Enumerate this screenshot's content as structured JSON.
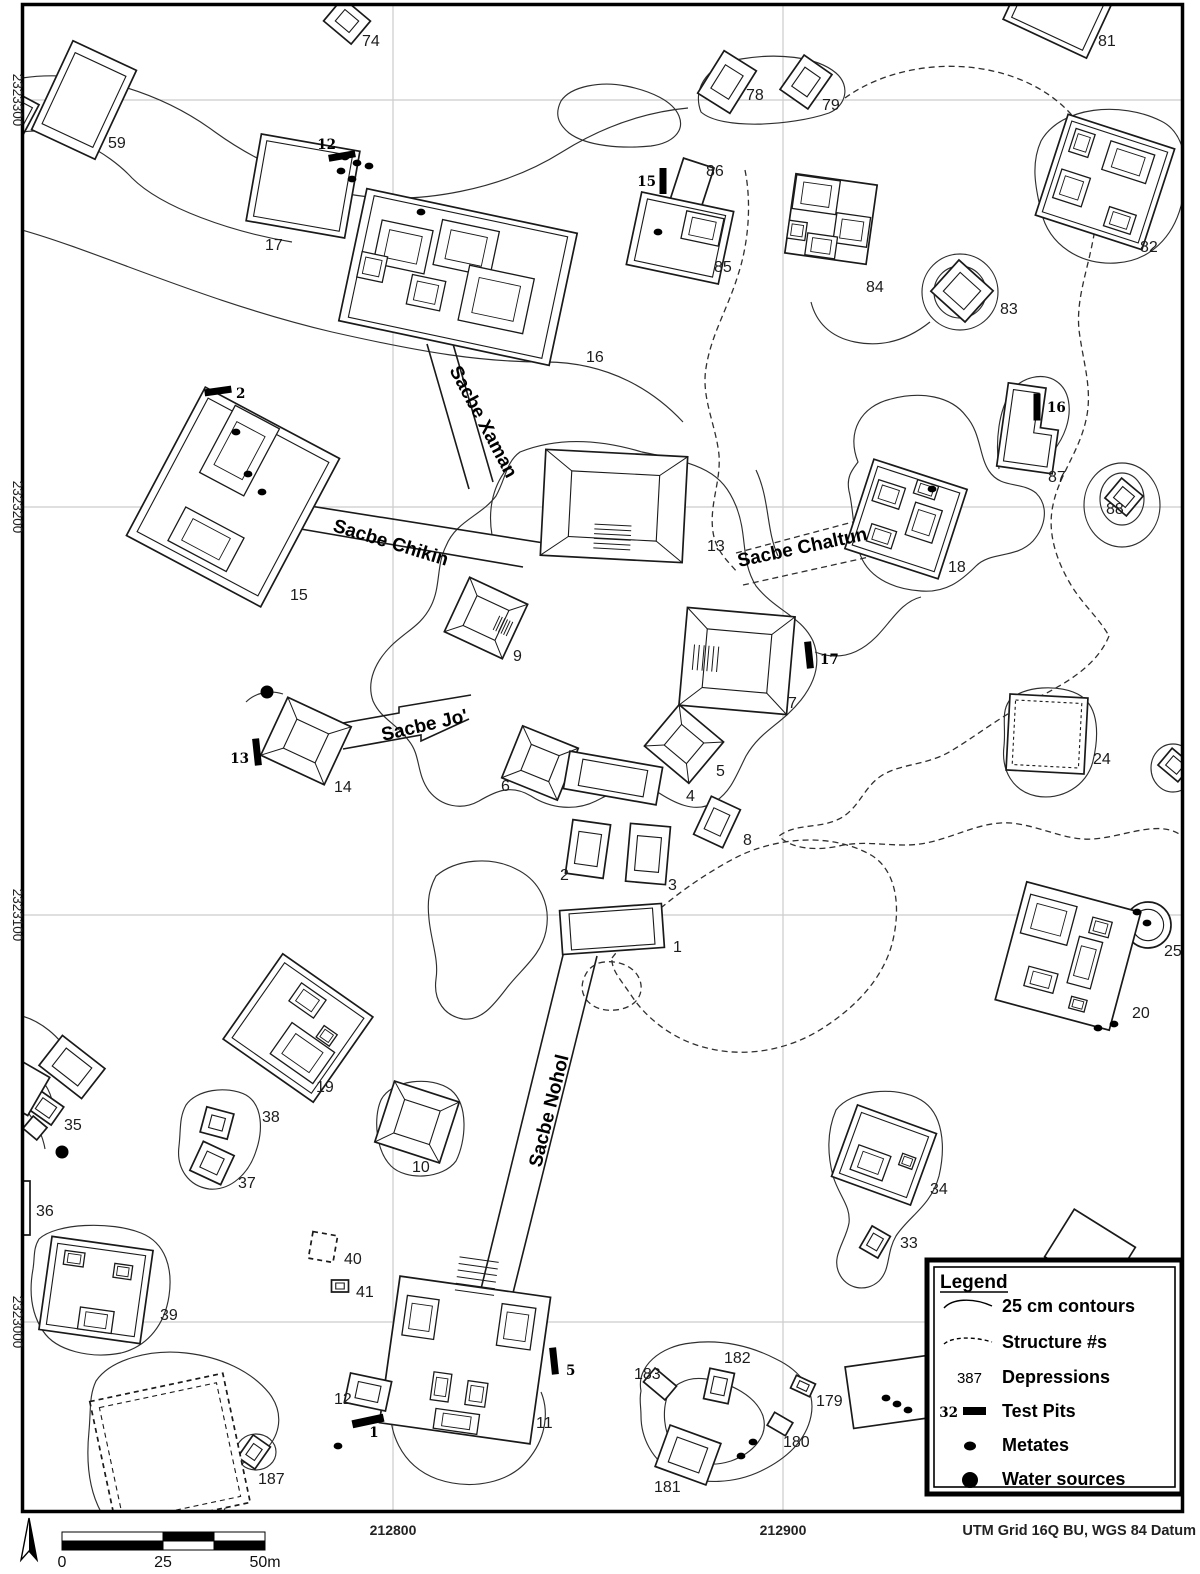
{
  "map": {
    "axis": {
      "left_labels": [
        {
          "text": "2323300",
          "y": 100
        },
        {
          "text": "2323200",
          "y": 507
        },
        {
          "text": "2323100",
          "y": 915
        },
        {
          "text": "2323000",
          "y": 1322
        }
      ],
      "bottom_labels": [
        {
          "text": "212800",
          "x": 393
        },
        {
          "text": "212900",
          "x": 783
        }
      ],
      "datum_note": "UTM Grid 16Q BU, WGS 84 Datum"
    },
    "grid": {
      "vxs": [
        393,
        783
      ],
      "hys": [
        100,
        507,
        915,
        1322
      ]
    },
    "sacbes": [
      {
        "name": "Sacbe Xaman",
        "x": 449,
        "y": 370,
        "angle": 62
      },
      {
        "name": "Sacbe Chikin",
        "x": 332,
        "y": 531,
        "angle": 17
      },
      {
        "name": "Sacbe Chaltun",
        "x": 739,
        "y": 567,
        "angle": -12
      },
      {
        "name": "Sacbe Jo'",
        "x": 383,
        "y": 741,
        "angle": -13
      },
      {
        "name": "Sacbe Nohol",
        "x": 541,
        "y": 1168,
        "angle": -76
      }
    ],
    "structures": [
      {
        "n": "74",
        "cx": 347,
        "cy": 21,
        "w": 36,
        "h": 30,
        "rot": 40,
        "rings": 2,
        "is": 0.5,
        "lx": 362,
        "ly": 46
      },
      {
        "n": "59",
        "cx": 84,
        "cy": 100,
        "w": 70,
        "h": 98,
        "rot": 25,
        "rings": 2,
        "is": 0.8,
        "lx": 108,
        "ly": 148
      },
      {
        "n": "8",
        "cx": 6,
        "cy": 120,
        "w": 44,
        "h": 58,
        "rot": 28,
        "rings": 2,
        "is": 0.8,
        "lx": 13,
        "ly": 150
      },
      {
        "n": "17",
        "cx": 303,
        "cy": 186,
        "w": 100,
        "h": 88,
        "rot": 10,
        "rings": 2,
        "is": 0.87,
        "lx": 265,
        "ly": 250
      },
      {
        "n": "16",
        "cx": 458,
        "cy": 277,
        "w": 215,
        "h": 135,
        "rot": 12,
        "rings": 2,
        "is": 0.92,
        "inner": [
          [
            -60,
            -18,
            52,
            44
          ],
          [
            2,
            -30,
            58,
            46
          ],
          [
            42,
            14,
            66,
            56
          ],
          [
            -28,
            22,
            34,
            30
          ],
          [
            -86,
            8,
            26,
            26
          ]
        ],
        "lx": 586,
        "ly": 362
      },
      {
        "n": "86",
        "cx": 692,
        "cy": 184,
        "w": 32,
        "h": 44,
        "rot": 18,
        "rings": 1,
        "lx": 706,
        "ly": 176
      },
      {
        "n": "85",
        "cx": 680,
        "cy": 238,
        "w": 94,
        "h": 74,
        "rot": 12,
        "rings": 2,
        "is": 0.85,
        "inner": [
          [
            20,
            -14,
            38,
            28
          ]
        ],
        "lx": 714,
        "ly": 272
      },
      {
        "n": "78",
        "cx": 727,
        "cy": 82,
        "w": 38,
        "h": 50,
        "rot": 32,
        "rings": 2,
        "is": 0.55,
        "lx": 746,
        "ly": 100
      },
      {
        "n": "79",
        "cx": 806,
        "cy": 82,
        "w": 34,
        "h": 42,
        "rot": 35,
        "rings": 2,
        "is": 0.55,
        "lx": 822,
        "ly": 110
      },
      {
        "n": "84",
        "cx": 831,
        "cy": 219,
        "w": 82,
        "h": 80,
        "rot": 8,
        "rings": 1,
        "inner": [
          [
            -18,
            -22,
            44,
            34
          ],
          [
            22,
            8,
            34,
            30
          ],
          [
            -6,
            28,
            30,
            22
          ],
          [
            -32,
            16,
            18,
            18
          ]
        ],
        "lx": 866,
        "ly": 292
      },
      {
        "n": "83",
        "cx": 962,
        "cy": 291,
        "w": 46,
        "h": 42,
        "rot": 42,
        "rings": 2,
        "is": 0.6,
        "lx": 1000,
        "ly": 314
      },
      {
        "n": "82",
        "cx": 1105,
        "cy": 182,
        "w": 112,
        "h": 106,
        "rot": 18,
        "rings": 2,
        "is": 0.9,
        "inner": [
          [
            16,
            -26,
            46,
            30
          ],
          [
            -30,
            16,
            30,
            30
          ],
          [
            26,
            32,
            28,
            20
          ],
          [
            -34,
            -30,
            20,
            24
          ]
        ],
        "lx": 1140,
        "ly": 252
      },
      {
        "n": "81",
        "cx": 1060,
        "cy": 6,
        "w": 92,
        "h": 72,
        "rot": 25,
        "rings": 2,
        "is": 0.85,
        "lx": 1098,
        "ly": 46
      },
      {
        "n": "15",
        "cx": 233,
        "cy": 497,
        "w": 152,
        "h": 168,
        "rot": 28,
        "rings": 2,
        "is": 0.9,
        "inner": [
          [
            -16,
            -44,
            50,
            76
          ],
          [
            -4,
            50,
            66,
            38
          ]
        ],
        "lx": 290,
        "ly": 600
      },
      {
        "n": "13",
        "cx": 614,
        "cy": 506,
        "w": 142,
        "h": 106,
        "rot": 3,
        "rings": 2,
        "is": 0.62,
        "pyr": true,
        "stairs": "s",
        "lx": 707,
        "ly": 551
      },
      {
        "n": "9",
        "cx": 486,
        "cy": 618,
        "w": 64,
        "h": 60,
        "rot": 25,
        "rings": 2,
        "is": 0.55,
        "pyr": true,
        "stairs": "e",
        "lx": 513,
        "ly": 661
      },
      {
        "n": "18",
        "cx": 906,
        "cy": 519,
        "w": 98,
        "h": 94,
        "rot": 18,
        "rings": 2,
        "is": 0.88,
        "inner": [
          [
            -24,
            -18,
            28,
            22
          ],
          [
            18,
            -2,
            28,
            34
          ],
          [
            -18,
            24,
            26,
            18
          ],
          [
            10,
            -34,
            22,
            14
          ]
        ],
        "lx": 948,
        "ly": 572
      },
      {
        "n": "87",
        "cx": 1028,
        "cy": 430,
        "rot": 8,
        "shape": "L",
        "lx": 1048,
        "ly": 482
      },
      {
        "n": "88",
        "cx": 1124,
        "cy": 497,
        "w": 28,
        "h": 26,
        "rot": 40,
        "rings": 2,
        "is": 0.55,
        "lx": 1106,
        "ly": 514
      },
      {
        "n": "7",
        "cx": 737,
        "cy": 661,
        "w": 108,
        "h": 98,
        "rot": 5,
        "rings": 2,
        "is": 0.6,
        "pyr": true,
        "stairs": "w",
        "lx": 788,
        "ly": 708
      },
      {
        "n": "24",
        "cx": 1047,
        "cy": 734,
        "w": 78,
        "h": 76,
        "rot": 3,
        "rings": 2,
        "is": 0.85,
        "inner_dashed": true,
        "lx": 1093,
        "ly": 764
      },
      {
        "n": "",
        "cx": 1175,
        "cy": 765,
        "w": 26,
        "h": 22,
        "rot": 40,
        "rings": 2,
        "is": 0.55
      },
      {
        "n": "14",
        "cx": 306,
        "cy": 741,
        "w": 70,
        "h": 64,
        "rot": 25,
        "rings": 2,
        "is": 0.5,
        "pyr": true,
        "lx": 334,
        "ly": 792
      },
      {
        "n": "6",
        "cx": 540,
        "cy": 763,
        "w": 60,
        "h": 56,
        "rot": 22,
        "rings": 2,
        "is": 0.5,
        "pyr": true,
        "lx": 501,
        "ly": 791
      },
      {
        "n": "5",
        "cx": 684,
        "cy": 744,
        "w": 58,
        "h": 54,
        "rot": 40,
        "rings": 2,
        "is": 0.5,
        "pyr": true,
        "lx": 716,
        "ly": 776
      },
      {
        "n": "4",
        "cx": 613,
        "cy": 778,
        "w": 94,
        "h": 38,
        "rot": 10,
        "rings": 2,
        "is": 0.7,
        "lx": 686,
        "ly": 801
      },
      {
        "n": "8",
        "cx": 717,
        "cy": 822,
        "w": 32,
        "h": 42,
        "rot": 25,
        "rings": 2,
        "is": 0.55,
        "lx": 743,
        "ly": 845
      },
      {
        "n": "2",
        "cx": 588,
        "cy": 849,
        "w": 38,
        "h": 54,
        "rot": 8,
        "rings": 2,
        "is": 0.6,
        "lx": 560,
        "ly": 880
      },
      {
        "n": "3",
        "cx": 648,
        "cy": 854,
        "w": 40,
        "h": 58,
        "rot": 5,
        "rings": 2,
        "is": 0.6,
        "lx": 668,
        "ly": 890
      },
      {
        "n": "1",
        "cx": 612,
        "cy": 929,
        "w": 102,
        "h": 44,
        "rot": -4,
        "rings": 2,
        "is": 0.82,
        "lx": 673,
        "ly": 952
      },
      {
        "n": "19",
        "cx": 298,
        "cy": 1028,
        "w": 110,
        "h": 104,
        "rot": 35,
        "rings": 2,
        "is": 0.88,
        "inner": [
          [
            -8,
            -28,
            30,
            22
          ],
          [
            18,
            18,
            52,
            38
          ],
          [
            28,
            -10,
            16,
            14
          ]
        ],
        "lx": 316,
        "ly": 1092
      },
      {
        "n": "10",
        "cx": 417,
        "cy": 1122,
        "w": 68,
        "h": 64,
        "rot": 18,
        "rings": 2,
        "is": 0.55,
        "pyr": true,
        "lx": 412,
        "ly": 1172
      },
      {
        "n": "38",
        "cx": 217,
        "cy": 1123,
        "w": 28,
        "h": 26,
        "rot": 15,
        "rings": 2,
        "is": 0.5,
        "lx": 262,
        "ly": 1122
      },
      {
        "n": "37",
        "cx": 212,
        "cy": 1163,
        "w": 34,
        "h": 32,
        "rot": 25,
        "rings": 2,
        "is": 0.55,
        "lx": 238,
        "ly": 1188
      },
      {
        "n": "35",
        "cx": 72,
        "cy": 1067,
        "w": 54,
        "h": 38,
        "rot": 38,
        "rings": 2,
        "is": 0.6,
        "lx": 64,
        "ly": 1130
      },
      {
        "n": "",
        "cx": 46,
        "cy": 1108,
        "w": 28,
        "h": 22,
        "rot": 35,
        "rings": 2,
        "is": 0.6
      },
      {
        "n": "",
        "cx": 35,
        "cy": 1128,
        "w": 18,
        "h": 16,
        "rot": 40,
        "rings": 1
      },
      {
        "n": "",
        "cx": 24,
        "cy": 1088,
        "w": 34,
        "h": 44,
        "rot": 30,
        "rings": 1
      },
      {
        "n": "36",
        "cx": 26,
        "cy": 1208,
        "w": 8,
        "h": 54,
        "rot": 0,
        "rings": 1,
        "lx": 36,
        "ly": 1216
      },
      {
        "n": "39",
        "cx": 96,
        "cy": 1290,
        "w": 102,
        "h": 94,
        "rot": 8,
        "rings": 2,
        "is": 0.87,
        "inner": [
          [
            -26,
            -28,
            20,
            14
          ],
          [
            24,
            -22,
            18,
            14
          ],
          [
            4,
            30,
            34,
            22
          ]
        ],
        "lx": 160,
        "ly": 1320
      },
      {
        "n": "40",
        "cx": 323,
        "cy": 1247,
        "w": 25,
        "h": 27,
        "rot": 10,
        "rings": 1,
        "dashed": true,
        "lx": 344,
        "ly": 1264
      },
      {
        "n": "41",
        "cx": 340,
        "cy": 1286,
        "w": 17,
        "h": 12,
        "rot": 0,
        "rings": 2,
        "is": 0.5,
        "lx": 356,
        "ly": 1297
      },
      {
        "n": "11",
        "cx": 465,
        "cy": 1360,
        "w": 152,
        "h": 148,
        "rot": 8,
        "rings": 1,
        "stairs": "n",
        "inner": [
          [
            -50,
            -36,
            32,
            40
          ],
          [
            46,
            -40,
            34,
            42
          ],
          [
            -20,
            30,
            18,
            28
          ],
          [
            16,
            32,
            20,
            24
          ],
          [
            0,
            62,
            44,
            20
          ]
        ],
        "lx": 536,
        "ly": 1428
      },
      {
        "n": "12",
        "cx": 368,
        "cy": 1392,
        "w": 42,
        "h": 30,
        "rot": 12,
        "rings": 2,
        "is": 0.55,
        "lx": 334,
        "ly": 1404
      },
      {
        "n": "183",
        "cx": 660,
        "cy": 1384,
        "w": 28,
        "h": 18,
        "rot": 40,
        "rings": 1,
        "lx": 634,
        "ly": 1379
      },
      {
        "n": "182",
        "cx": 719,
        "cy": 1386,
        "w": 25,
        "h": 31,
        "rot": 12,
        "rings": 2,
        "is": 0.55,
        "lx": 724,
        "ly": 1363
      },
      {
        "n": "181",
        "cx": 688,
        "cy": 1455,
        "w": 54,
        "h": 44,
        "rot": 20,
        "rings": 2,
        "is": 0.6,
        "lx": 654,
        "ly": 1492
      },
      {
        "n": "179",
        "cx": 803,
        "cy": 1386,
        "w": 21,
        "h": 14,
        "rot": 25,
        "rings": 2,
        "is": 0.5,
        "lx": 816,
        "ly": 1406
      },
      {
        "n": "180",
        "cx": 780,
        "cy": 1424,
        "w": 21,
        "h": 15,
        "rot": 30,
        "rings": 1,
        "lx": 783,
        "ly": 1447
      },
      {
        "n": "34",
        "cx": 884,
        "cy": 1155,
        "w": 84,
        "h": 76,
        "rot": 20,
        "rings": 2,
        "is": 0.85,
        "inner": [
          [
            -10,
            12,
            34,
            26
          ],
          [
            24,
            -2,
            14,
            12
          ]
        ],
        "lx": 930,
        "ly": 1194
      },
      {
        "n": "33",
        "cx": 875,
        "cy": 1242,
        "w": 21,
        "h": 25,
        "rot": 30,
        "rings": 2,
        "is": 0.55,
        "lx": 900,
        "ly": 1248
      },
      {
        "n": "187",
        "cx": 254,
        "cy": 1452,
        "w": 21,
        "h": 27,
        "rot": 35,
        "rings": 2,
        "is": 0.5,
        "lx": 258,
        "ly": 1484
      },
      {
        "n": "",
        "cx": 170,
        "cy": 1452,
        "w": 136,
        "h": 132,
        "rot": -12,
        "rings": 2,
        "is": 0.88,
        "dashed": true
      },
      {
        "n": "",
        "cx": 890,
        "cy": 1392,
        "w": 82,
        "h": 62,
        "rot": -8,
        "rings": 1
      },
      {
        "n": "",
        "cx": 1090,
        "cy": 1252,
        "w": 72,
        "h": 56,
        "rot": 32,
        "rings": 1
      },
      {
        "n": "",
        "cx": 1184,
        "cy": 1404,
        "w": 28,
        "h": 28,
        "rot": 45,
        "rings": 2,
        "is": 0.5
      },
      {
        "n": "25",
        "cx": 1148,
        "cy": 925,
        "shape": "circle",
        "r": 23,
        "lx": 1164,
        "ly": 956
      },
      {
        "n": "20",
        "cx": 1068,
        "cy": 956,
        "w": 118,
        "h": 122,
        "rot": 15,
        "rings": 1,
        "inner": [
          [
            -28,
            -30,
            48,
            40
          ],
          [
            24,
            -36,
            20,
            16
          ],
          [
            18,
            2,
            24,
            48
          ],
          [
            -20,
            30,
            30,
            20
          ],
          [
            22,
            44,
            16,
            12
          ]
        ],
        "lx": 1132,
        "ly": 1018
      }
    ],
    "test_pits": [
      {
        "n": "12",
        "bx": 342,
        "by": 156,
        "bw": 27,
        "bh": 7,
        "rot": -10,
        "lx": 336,
        "ly": 149,
        "ta": "end"
      },
      {
        "n": "2",
        "bx": 218,
        "by": 391,
        "bw": 27,
        "bh": 7,
        "rot": -8,
        "lx": 236,
        "ly": 398,
        "ta": "start"
      },
      {
        "n": "15",
        "bx": 663,
        "by": 181,
        "bw": 7,
        "bh": 26,
        "rot": 0,
        "lx": 656,
        "ly": 186,
        "ta": "end"
      },
      {
        "n": "16",
        "bx": 1037,
        "by": 407,
        "bw": 7,
        "bh": 27,
        "rot": 0,
        "lx": 1047,
        "ly": 412,
        "ta": "start"
      },
      {
        "n": "17",
        "bx": 809,
        "by": 655,
        "bw": 7,
        "bh": 27,
        "rot": -6,
        "lx": 820,
        "ly": 664,
        "ta": "start"
      },
      {
        "n": "13",
        "bx": 257,
        "by": 752,
        "bw": 7,
        "bh": 27,
        "rot": -6,
        "lx": 249,
        "ly": 763,
        "ta": "end"
      },
      {
        "n": "5",
        "bx": 554,
        "by": 1361,
        "bw": 7,
        "bh": 27,
        "rot": -6,
        "lx": 566,
        "ly": 1375,
        "ta": "start"
      },
      {
        "n": "1",
        "bx": 368,
        "by": 1421,
        "bw": 32,
        "bh": 8,
        "rot": -12,
        "lx": 374,
        "ly": 1437,
        "ta": "middle"
      }
    ],
    "metates": [
      [
        345,
        157
      ],
      [
        357,
        163
      ],
      [
        369,
        166
      ],
      [
        341,
        171
      ],
      [
        352,
        179
      ],
      [
        421,
        212
      ],
      [
        658,
        232
      ],
      [
        236,
        432
      ],
      [
        248,
        474
      ],
      [
        262,
        492
      ],
      [
        932,
        489
      ],
      [
        1137,
        912
      ],
      [
        1147,
        923
      ],
      [
        1098,
        1028
      ],
      [
        1114,
        1024
      ],
      [
        886,
        1398
      ],
      [
        897,
        1404
      ],
      [
        908,
        1410
      ],
      [
        741,
        1456
      ],
      [
        753,
        1442
      ],
      [
        338,
        1446
      ]
    ],
    "water_sources": [
      [
        267,
        692
      ],
      [
        62,
        1152
      ]
    ],
    "standalone_labels": [
      {
        "text": "29",
        "x": 1186,
        "y": 1374
      }
    ]
  },
  "legend": {
    "title": "Legend",
    "rows": [
      {
        "symbol": "contour",
        "label": "25 cm contours"
      },
      {
        "symbol": "dashed",
        "label": "Structure #s"
      },
      {
        "symbol": "num",
        "num": "387",
        "label": "Depressions"
      },
      {
        "symbol": "testpit",
        "num": "32",
        "label": "Test Pits"
      },
      {
        "symbol": "metate",
        "label": "Metates"
      },
      {
        "symbol": "water",
        "label": "Water sources"
      }
    ]
  },
  "scale_bar": {
    "labels": [
      "0",
      "25",
      "50m"
    ]
  },
  "colors": {
    "line": "#1a1a1a",
    "contour": "#2f2f2f",
    "grid": "#cccccc"
  }
}
